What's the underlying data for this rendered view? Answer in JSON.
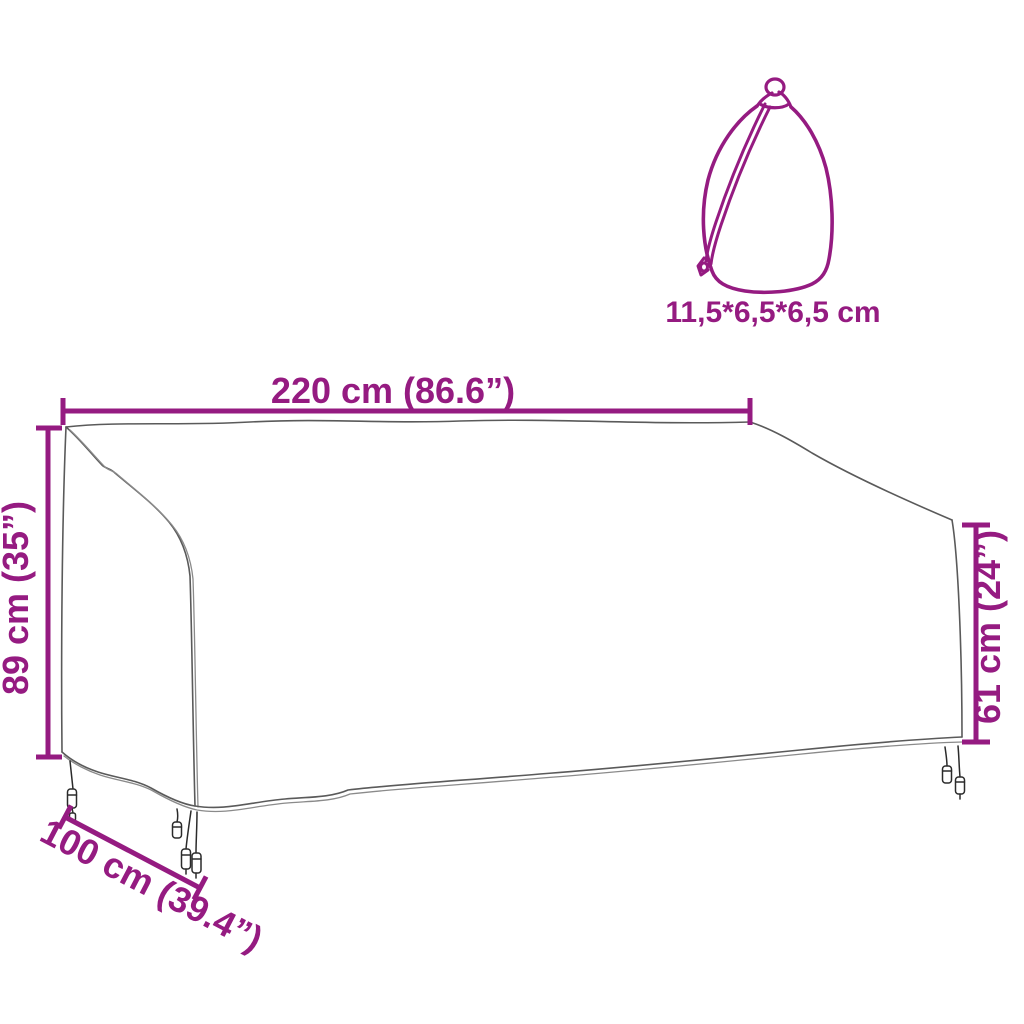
{
  "diagram": {
    "colors": {
      "accent": "#951B81",
      "drawing_line": "#5A5A5A"
    },
    "cover": {
      "name": "bench-cover-outline",
      "width_label": "220 cm (86.6”)",
      "back_height_label": "89 cm (35”)",
      "front_height_label": "61 cm (24”)",
      "depth_label": "100 cm (39.4”)"
    },
    "bag": {
      "name": "drawstring-storage-bag",
      "size_label": "11,5*6,5*6,5 cm"
    }
  }
}
